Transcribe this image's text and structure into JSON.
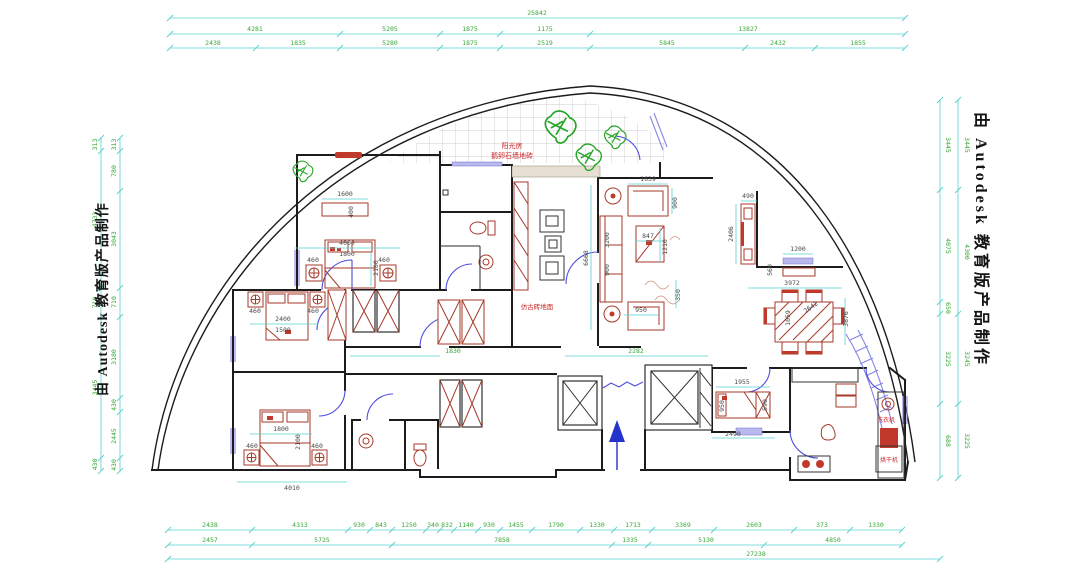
{
  "texts": {
    "watermark": "由 Autodesk 教育版产品制作",
    "sunroom_line1": "阳光房",
    "sunroom_line2": "鹅卵石墙地砖",
    "floor_note": "仿古砖地面",
    "washer": "洗衣机",
    "dryer": "烘干机"
  },
  "colors": {
    "dim_line": "#5ad1d1",
    "dim_text": "#3aa83a",
    "interior_dim": "#4a4a4a",
    "wall": "#1c1c1c",
    "furniture": "#a63a2a",
    "door": "#4d4de0",
    "window": "#8585e6",
    "plant": "#27a527",
    "note_red": "#cc2424",
    "entry_arrow": "#2433cc"
  },
  "dims": {
    "top": {
      "total": "25842",
      "row2": [
        "4281",
        "5205",
        "1875",
        "1175",
        "13827"
      ],
      "row3": [
        "2438",
        "1835",
        "5280",
        "1875",
        "2519",
        "5845",
        "2432",
        "1855"
      ]
    },
    "bottom": {
      "row1": [
        "2438",
        "4313",
        "930",
        "843",
        "1250",
        "340",
        "832",
        "1140",
        "930",
        "1455",
        "1790",
        "1330",
        "1713",
        "3369",
        "2603",
        "373",
        "1330"
      ],
      "row2": [
        "2457",
        "5725",
        "7858",
        "1335",
        "5130",
        "4850"
      ],
      "total": "27238"
    },
    "left": {
      "inner": [
        "313",
        "780",
        "3043",
        "710",
        "3180",
        "430",
        "2445",
        "430"
      ],
      "outer": [
        "313",
        "4733",
        "710",
        "3445",
        "430"
      ]
    },
    "right": {
      "inner": [
        "3445",
        "4075",
        "650",
        "3225",
        "688"
      ],
      "outer": [
        "3445",
        "4300",
        "3245",
        "3225"
      ]
    },
    "interior": [
      "1600",
      "400",
      "4000",
      "1800",
      "2100",
      "460",
      "460",
      "2400",
      "1500",
      "460",
      "460",
      "1800",
      "2100",
      "460",
      "460",
      "4010",
      "1830",
      "2282",
      "6668",
      "1639",
      "900",
      "3200",
      "847",
      "1210",
      "900",
      "950",
      "350",
      "490",
      "2406",
      "1200",
      "560",
      "3972",
      "1059",
      "2642",
      "3876",
      "1955",
      "950",
      "590",
      "2490"
    ]
  }
}
